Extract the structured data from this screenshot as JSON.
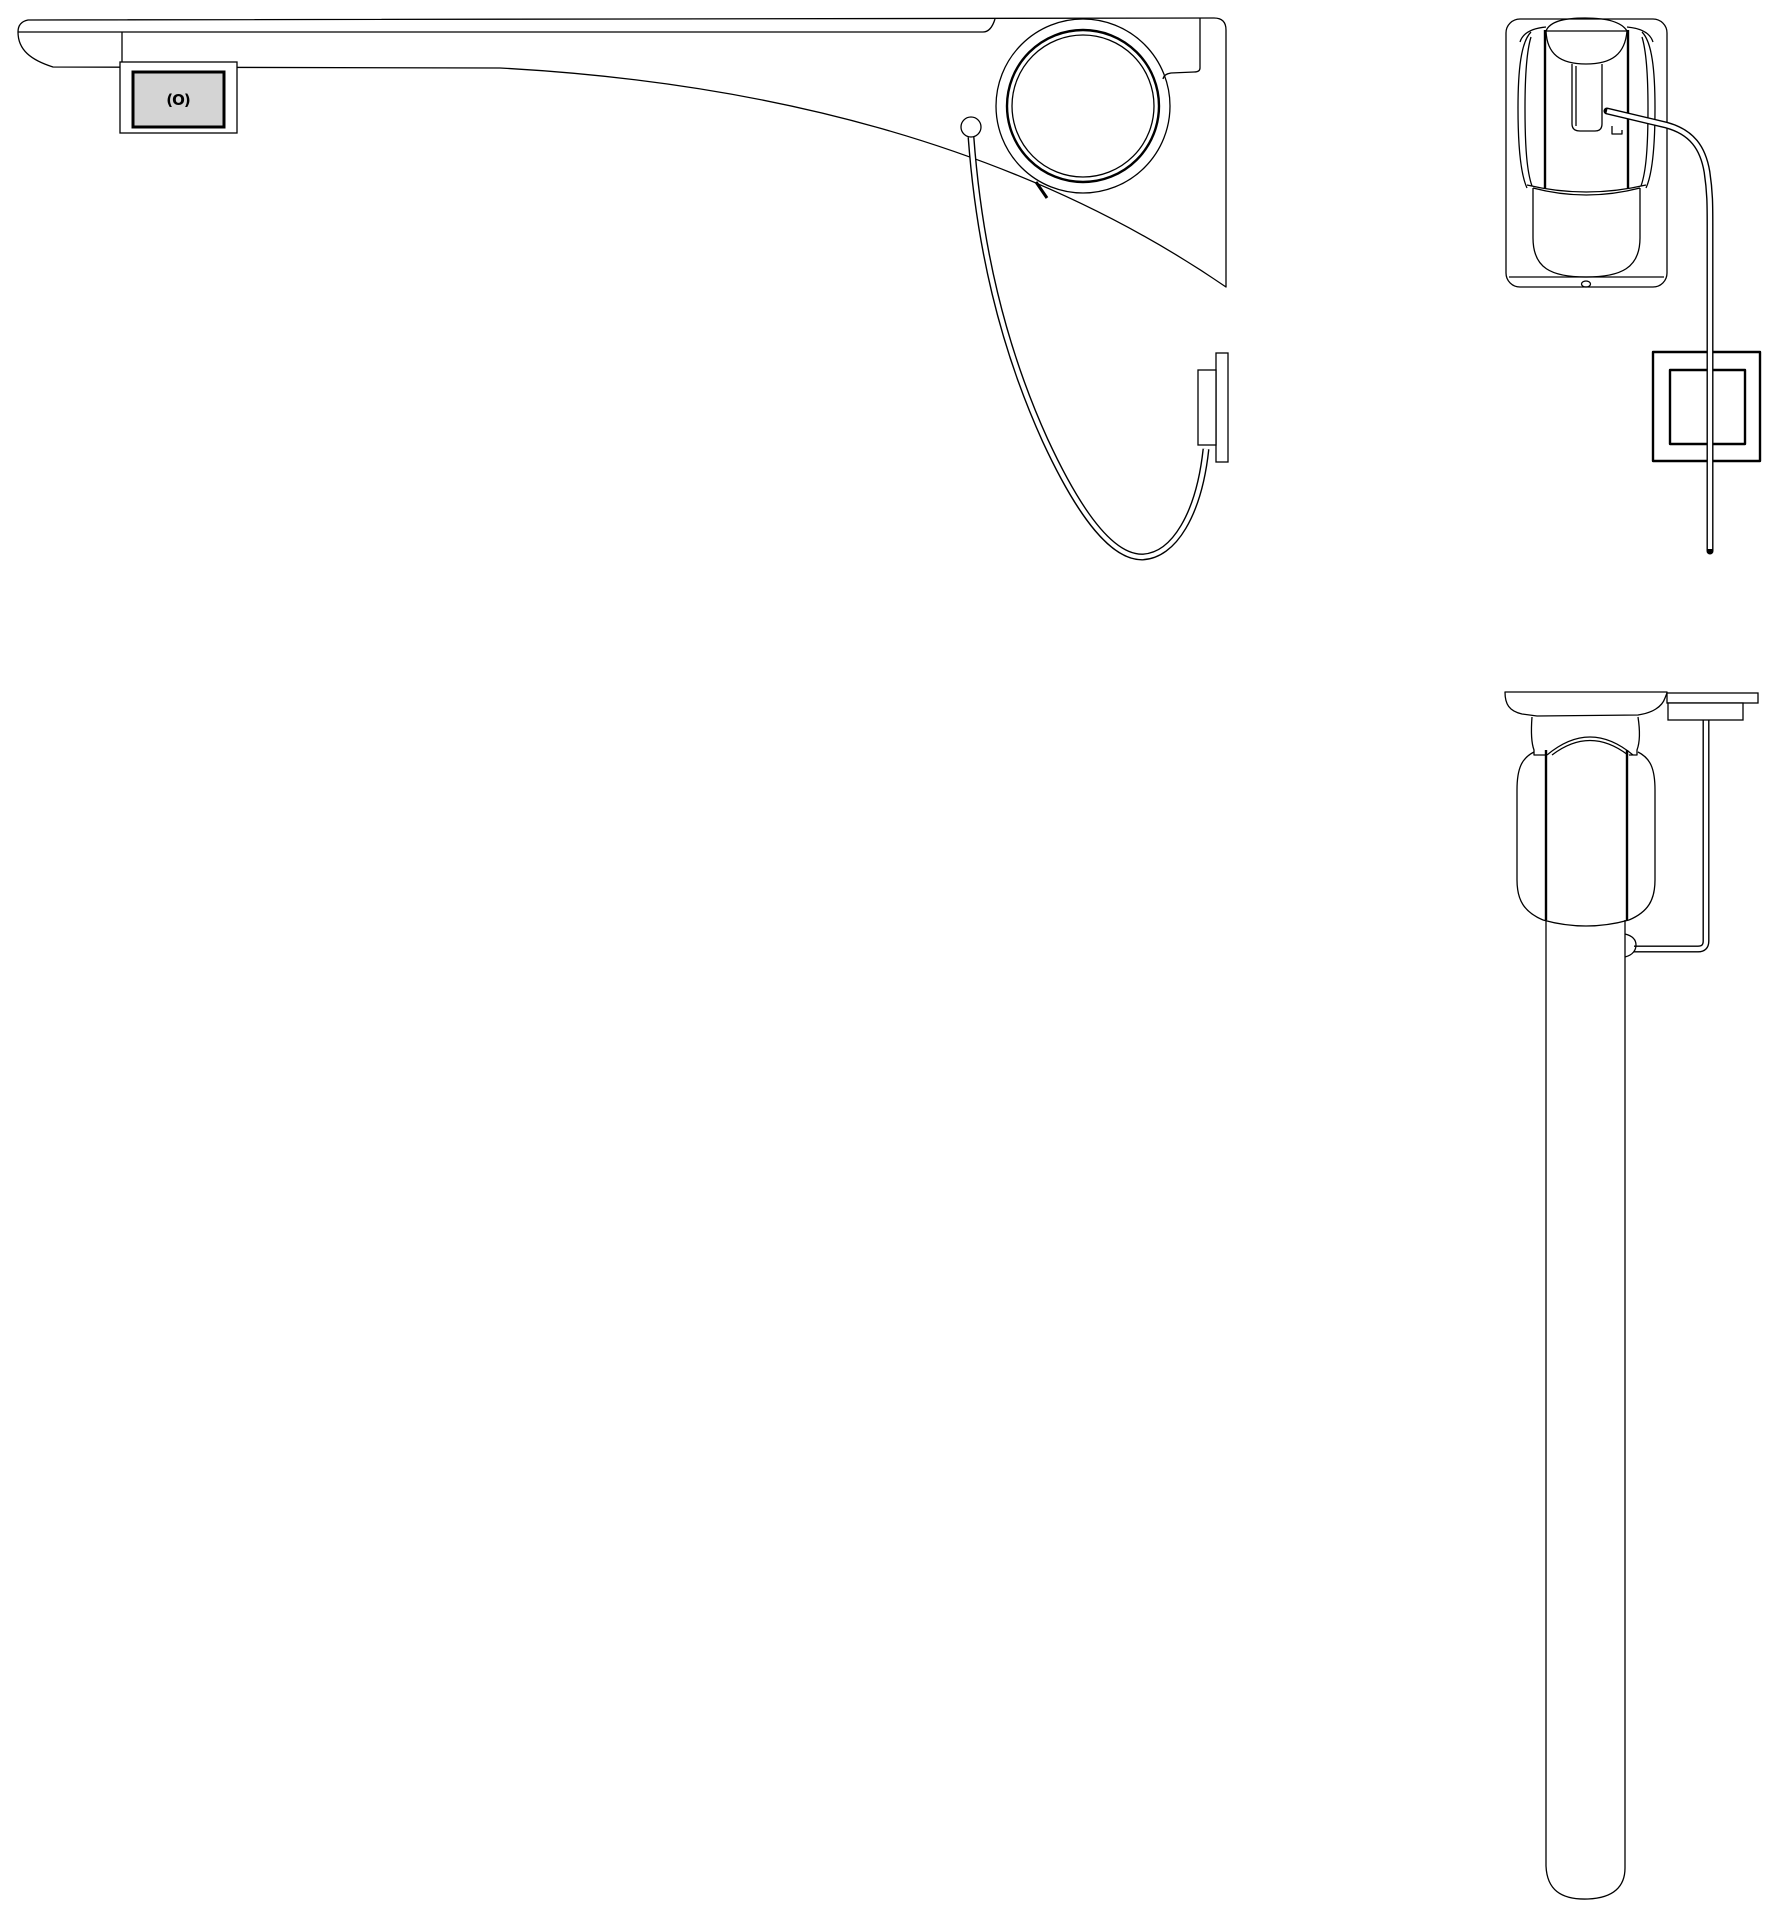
{
  "canvas": {
    "background": "#ffffff",
    "line_color": "#000000"
  },
  "sensor_window": {
    "glyph": "(O)",
    "fill": "#d4d4d4"
  }
}
